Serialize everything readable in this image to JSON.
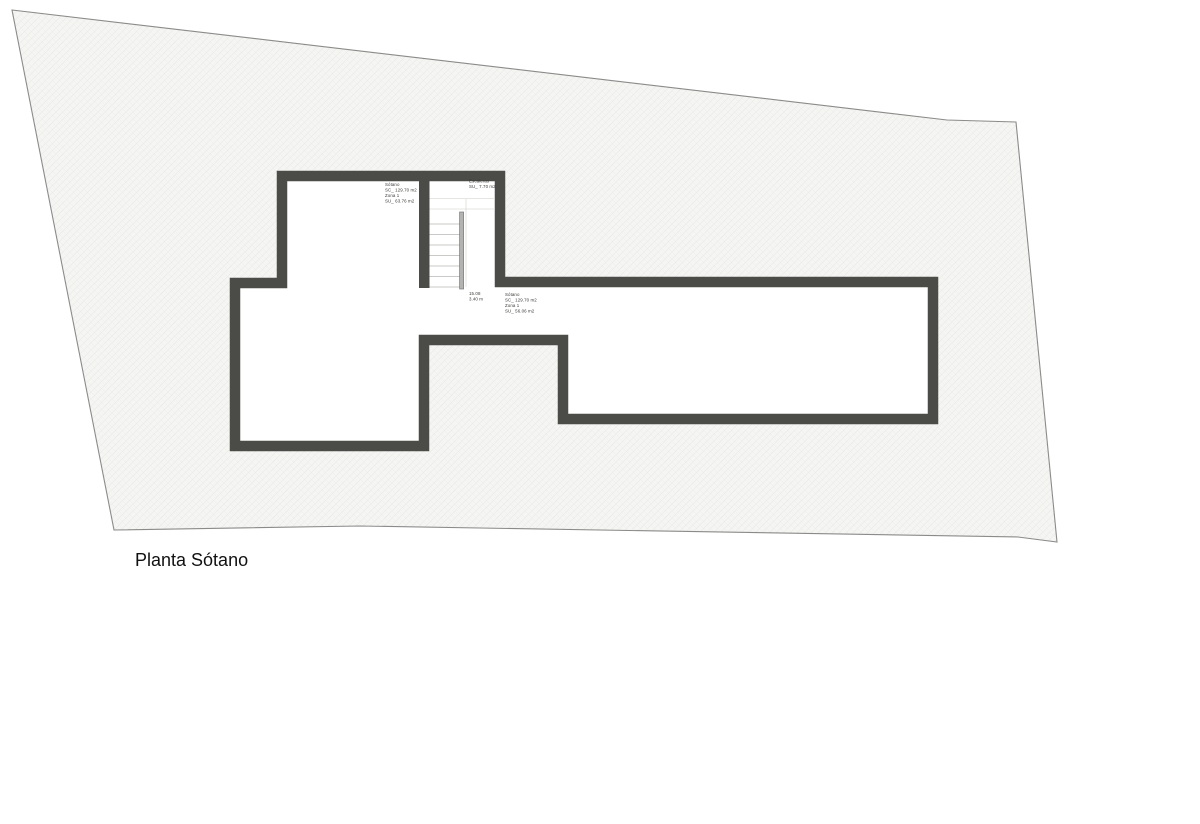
{
  "page": {
    "floor_title": "Planta Sótano"
  },
  "colors": {
    "wall": "#4b4b48",
    "site_fill": "#f5f5f3",
    "site_hatch": "#e7e7e4",
    "site_border": "#8b8b89",
    "tread": "#c9c9c7",
    "rail": "#b3b3b1",
    "rail_edge": "#787876",
    "background": "#ffffff",
    "label_text": "#3a3a38"
  },
  "labels": {
    "room_upper_left": {
      "lines": [
        "Sótano",
        "SC_ 129.70 m2",
        "Zona 1",
        "SU_ 63.76 m2"
      ]
    },
    "stairs": {
      "lines": [
        "Escaleras",
        "SU_ 7.70 m2"
      ]
    },
    "stair_dim": {
      "lines": [
        "15.08",
        "3.40 m"
      ]
    },
    "room_right": {
      "lines": [
        "Sótano",
        "SC_ 129.70 m2",
        "Zona 1",
        "SU_ 56.06 m2"
      ]
    }
  }
}
